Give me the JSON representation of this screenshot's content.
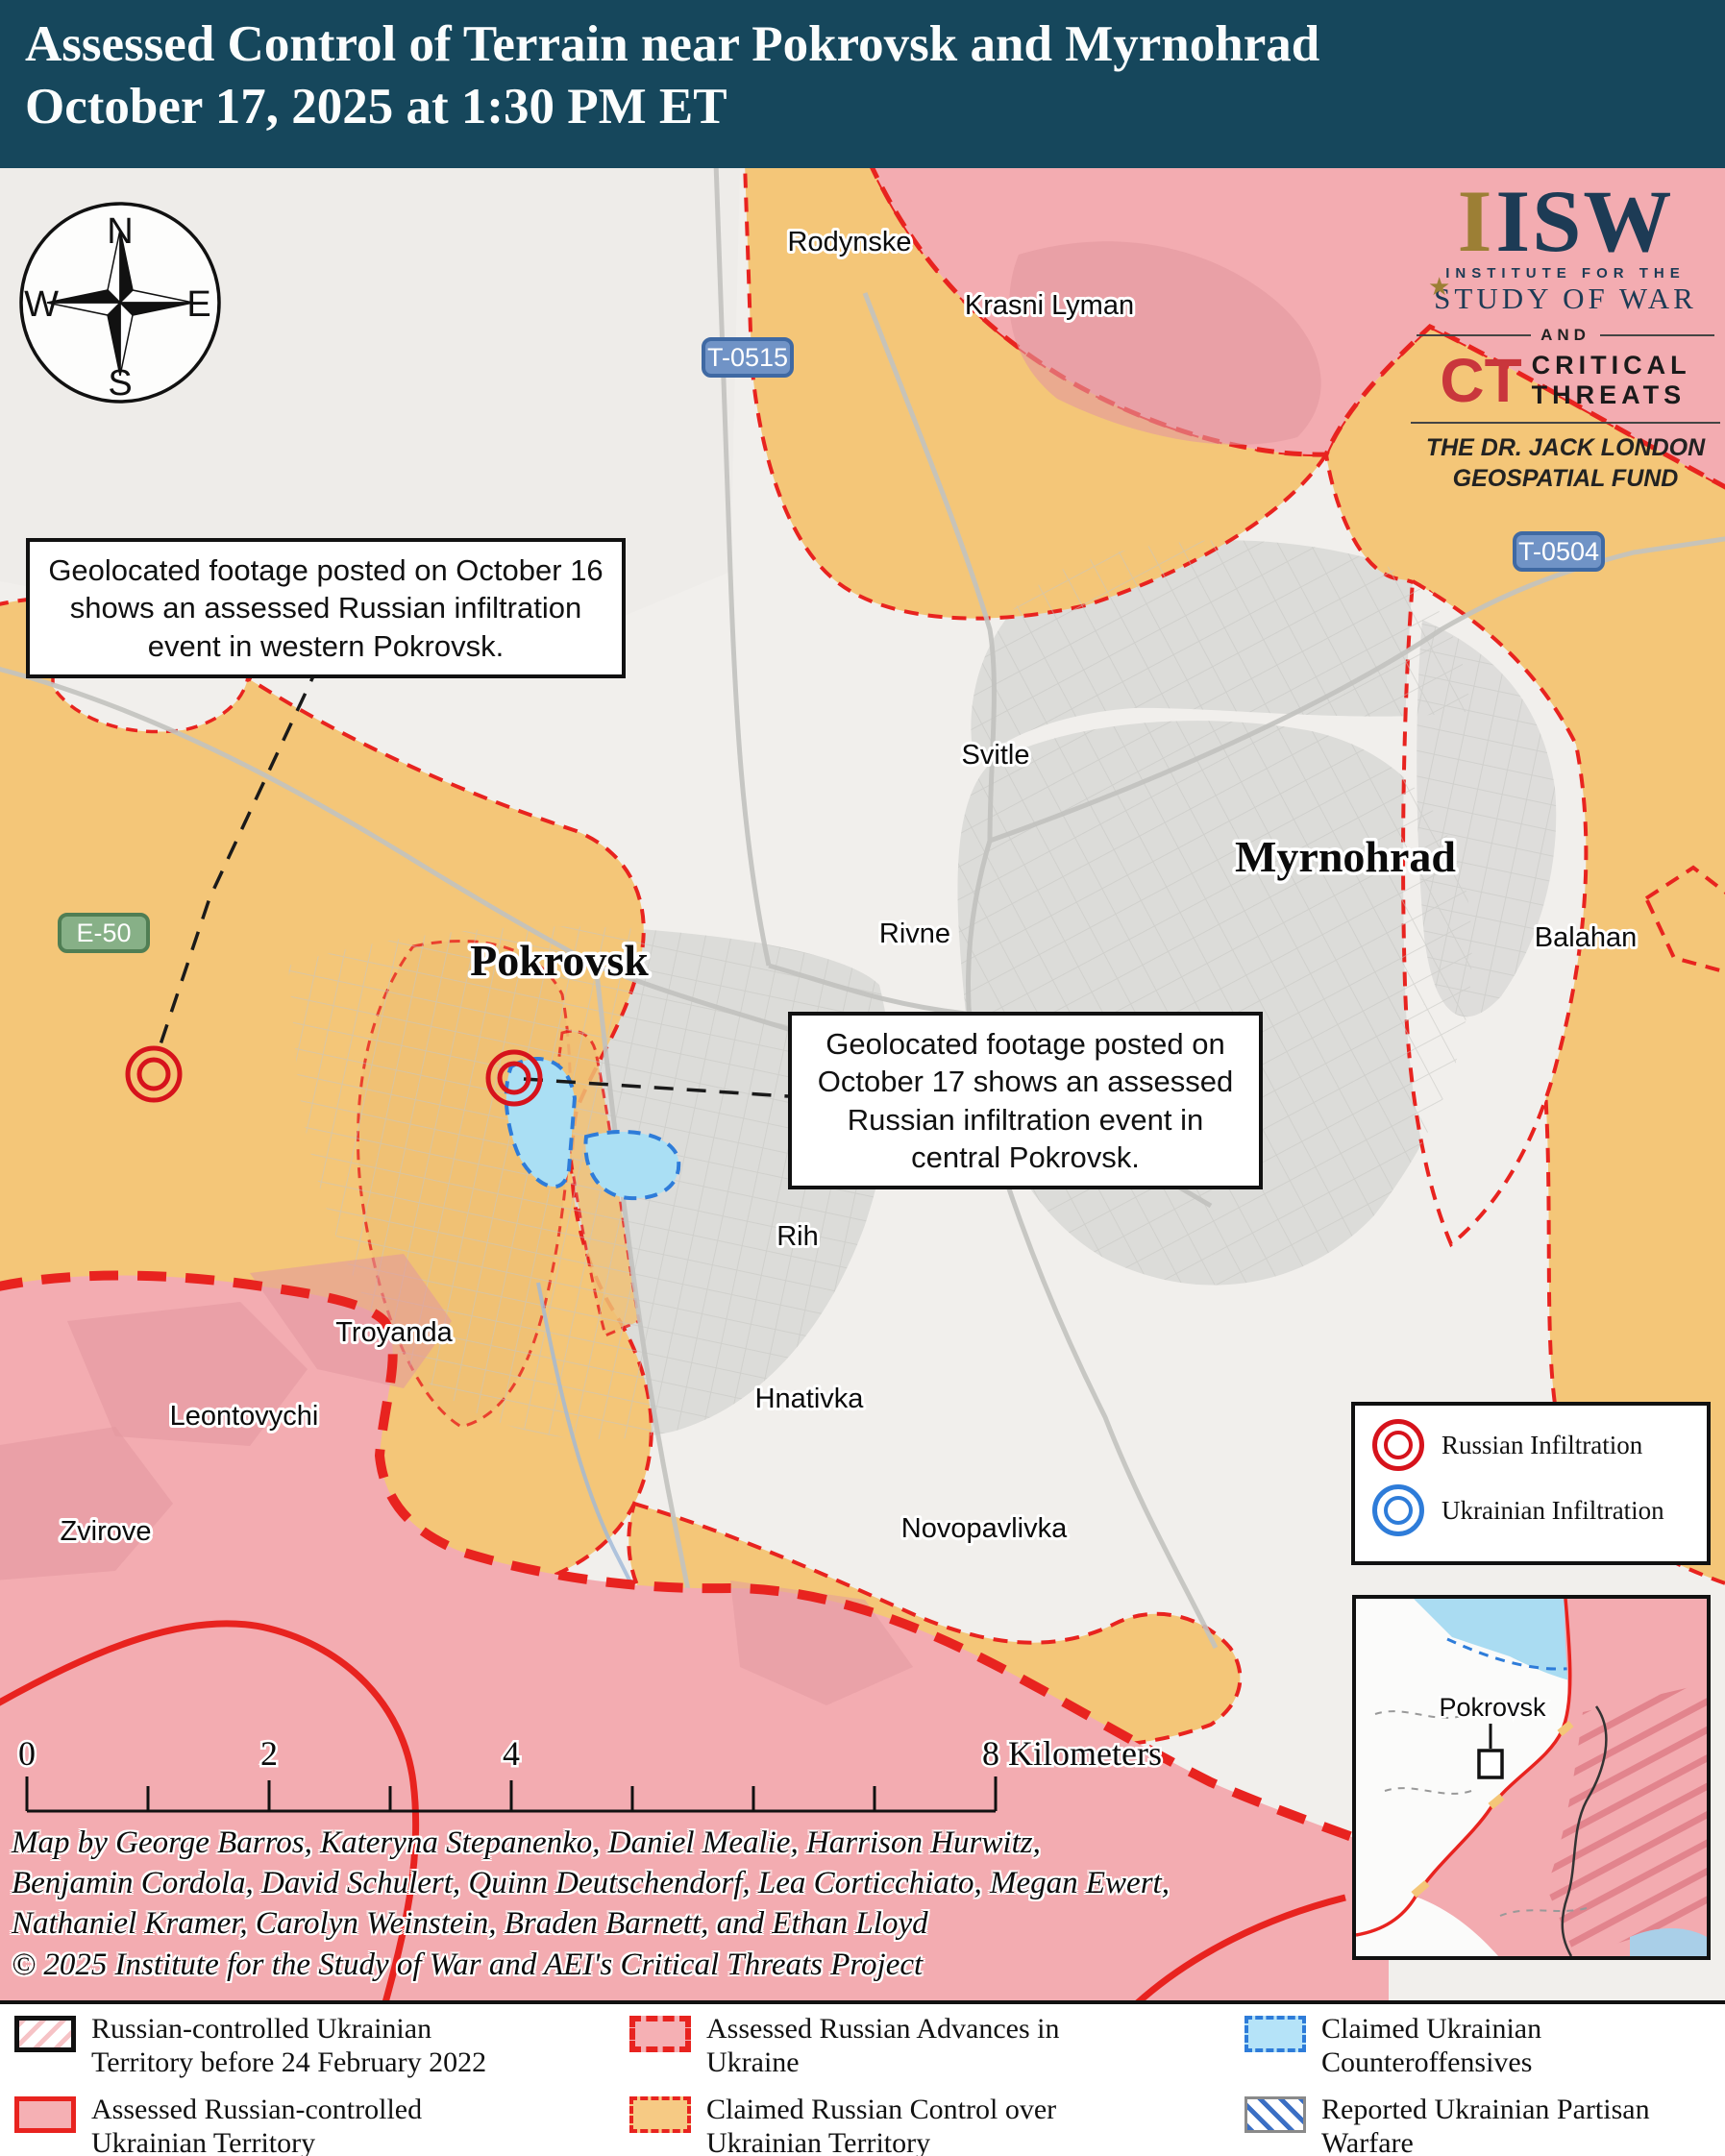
{
  "header": {
    "title_line1": "Assessed Control of Terrain near Pokrovsk and Myrnohrad",
    "title_line2": "October 17, 2025 at 1:30 PM ET"
  },
  "logos": {
    "isw_accent_letter": "I",
    "isw_acronym": "ISW",
    "isw_sub1": "INSTITUTE FOR THE",
    "isw_sub2": "STUDY OF WAR",
    "star": "★",
    "and_label": "AND",
    "ct_abbr": "CT",
    "ct_line1": "CRITICAL",
    "ct_line2": "THREATS",
    "fund_line1": "THE DR. JACK LONDON",
    "fund_line2": "GEOSPATIAL FUND"
  },
  "compass": {
    "n": "N",
    "e": "E",
    "s": "S",
    "w": "W"
  },
  "callouts": [
    {
      "text": "Geolocated footage posted on October 16 shows an assessed Russian infiltration event in western Pokrovsk."
    },
    {
      "text": "Geolocated footage posted on October 17 shows an assessed Russian infiltration event in central Pokrovsk."
    }
  ],
  "road_shields": [
    {
      "label": "T-0515",
      "type": "blue"
    },
    {
      "label": "T-0504",
      "type": "blue"
    },
    {
      "label": "E-50",
      "type": "green"
    }
  ],
  "towns": [
    {
      "name": "Rodynske",
      "tier": "town"
    },
    {
      "name": "Krasni Lyman",
      "tier": "town"
    },
    {
      "name": "Svitle",
      "tier": "town"
    },
    {
      "name": "Rivne",
      "tier": "town"
    },
    {
      "name": "Myrnohrad",
      "tier": "city"
    },
    {
      "name": "Pokrovsk",
      "tier": "city"
    },
    {
      "name": "Balahan",
      "tier": "town"
    },
    {
      "name": "Rih",
      "tier": "town"
    },
    {
      "name": "Hnativka",
      "tier": "town"
    },
    {
      "name": "Novopavlivka",
      "tier": "town"
    },
    {
      "name": "Troyanda",
      "tier": "town"
    },
    {
      "name": "Leontovychi",
      "tier": "town"
    },
    {
      "name": "Zvirove",
      "tier": "town"
    }
  ],
  "infiltration_legend": {
    "russian": "Russian Infiltration",
    "ukrainian": "Ukrainian Infiltration"
  },
  "inset": {
    "place_label": "Pokrovsk"
  },
  "scale_bar": {
    "tick_labels": [
      "0",
      "2",
      "4"
    ],
    "end_label": "8 Kilometers"
  },
  "credits": {
    "line1": "Map by George Barros, Kateryna Stepanenko, Daniel Mealie, Harrison Hurwitz,",
    "line2": "Benjamin Cordola, David Schulert, Quinn Deutschendorf, Lea Corticchiato, Megan Ewert,",
    "line3": "Nathaniel Kramer, Carolyn Weinstein, Braden Barnett, and Ethan Lloyd",
    "line4": "© 2025 Institute for the Study of War and AEI's Critical Threats Project"
  },
  "legend": {
    "items": [
      {
        "label": "Russian-controlled Ukrainian Territory before 24 February 2022",
        "swatch": "black-box-red-hatch"
      },
      {
        "label": "Assessed Russian-controlled Ukrainian Territory",
        "swatch": "red-border-pink-fill"
      },
      {
        "label": "Assessed Russian Advances in Ukraine",
        "swatch": "red-thick-dash-pink-fill"
      },
      {
        "label": "Claimed Russian Control over Ukrainian Territory",
        "swatch": "red-dash-orange-fill"
      },
      {
        "label": "Claimed Ukrainian Counteroffensives",
        "swatch": "blue-dash-lightblue-fill"
      },
      {
        "label": "Reported Ukrainian Partisan Warfare",
        "swatch": "gray-box-blue-hatch"
      }
    ]
  },
  "colors": {
    "header_bg": "#16475c",
    "russian_controlled_pink": "#f3acb1",
    "claimed_russian_orange": "#f4c678",
    "counteroffensive_blue": "#aadff4",
    "advance_red": "#e8231f",
    "ukrainian_blue": "#2e7cd9",
    "urban_gray": "#dcdcd9",
    "map_base": "#f1efec",
    "shield_blue": "#7093c6",
    "shield_green": "#87b087",
    "isw_navy": "#1d3b55",
    "isw_gold": "#9c7f35",
    "ct_red": "#c9363c"
  }
}
